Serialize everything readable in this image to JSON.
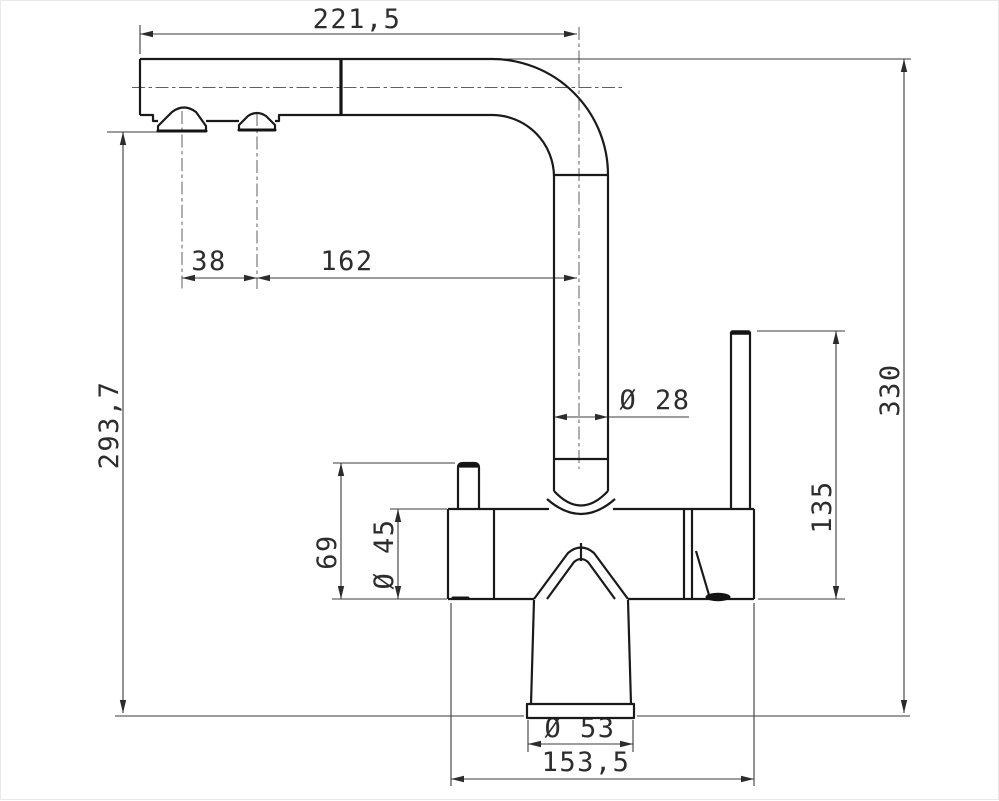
{
  "drawing": {
    "background": "#ffffff",
    "colors": {
      "outline": "#1a1a1a",
      "dimension_lines": "#3b3b3b",
      "dimension_text": "#2d2d2d",
      "centerline": "#5f5f5f"
    }
  },
  "dims": {
    "spout_reach": "221,5",
    "nozzle_spacing": "38",
    "nozzle_to_riser": "162",
    "spout_underside_height": "293,7",
    "riser_diameter": "Ø 28",
    "overall_height": "330",
    "lever_height": "135",
    "knob_height": "69",
    "body_diameter": "Ø 45",
    "base_diameter": "Ø 53",
    "body_length": "153,5"
  }
}
